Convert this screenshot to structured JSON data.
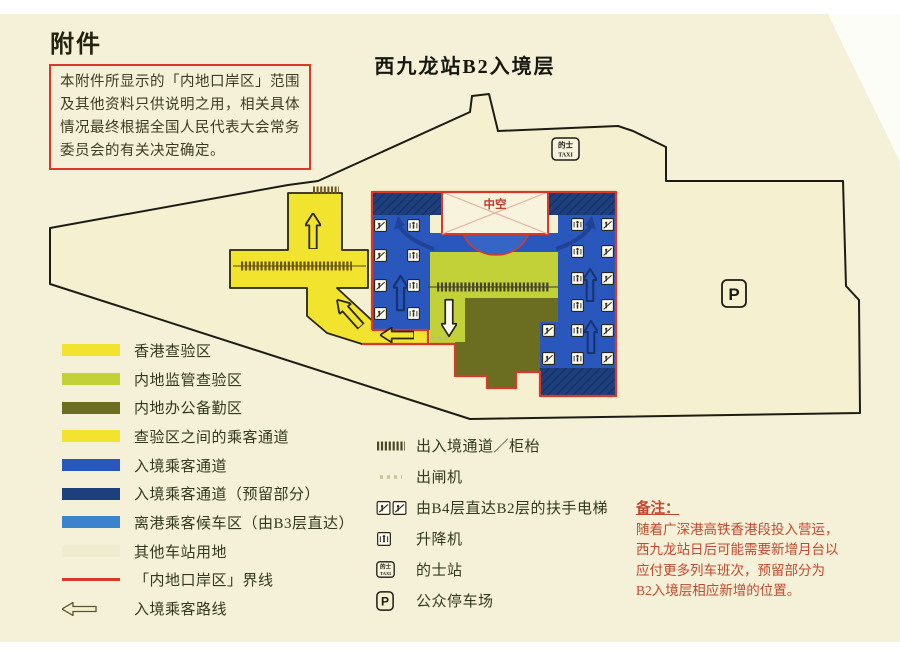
{
  "header": {
    "attachment_label": "附件",
    "disclaimer": "本附件所显示的「内地口岸区」范围及其他资料只供说明之用，相关具体情况最终根据全国人民代表大会常务委员会的有关决定确定。",
    "title": "西九龙站B2入境层"
  },
  "map": {
    "labels": {
      "void": "中空",
      "taxi_top": "的士",
      "taxi_bottom": "TAXI",
      "parking": "P"
    }
  },
  "area_legend": [
    {
      "label": "香港查验区",
      "color": "#f2e42e"
    },
    {
      "label": "内地监管查验区",
      "color": "#c2d138"
    },
    {
      "label": "内地办公备勤区",
      "color": "#6b6d20"
    },
    {
      "label": "查验区之间的乘客通道",
      "color": "#f2e42e"
    },
    {
      "label": "入境乘客通道",
      "color": "#2a57bb"
    },
    {
      "label": "入境乘客通道（预留部分）",
      "color": "#1d3f7e"
    },
    {
      "label": "离港乘客候车区（由B3层直达）",
      "color": "#3c82cd"
    },
    {
      "label": "其他车站用地",
      "color": "#f0ecd0"
    },
    {
      "label": "「内地口岸区」界线",
      "color": "#d8392b"
    },
    {
      "label": "入境乘客路线",
      "color": "#f3efcf"
    }
  ],
  "icon_legend": [
    {
      "icon": "counter-strip-icon",
      "label": "出入境通道／柜枱"
    },
    {
      "icon": "exit-gate-icon",
      "label": "出闸机"
    },
    {
      "icon": "escalator-pair-icon",
      "label": "由B4层直达B2层的扶手电梯"
    },
    {
      "icon": "lift-icon",
      "label": "升降机"
    },
    {
      "icon": "taxi-icon",
      "label": "的士站"
    },
    {
      "icon": "parking-icon",
      "label": "公众停车场"
    }
  ],
  "note": {
    "title": "备注：",
    "lines": [
      "随着广深港高铁香港段投入营运，",
      "西九龙站日后可能需要新增月台以",
      "应付更多列车班次，预留部分为",
      "B2入境层相应新增的位置。"
    ]
  },
  "colors": {
    "page_bg": "#f5f1d8",
    "station_fill": "#f4f0d0",
    "outline_black": "#1c1c14",
    "boundary_red": "#d8392b",
    "hk_yellow": "#f2e42e",
    "mainland_green": "#c2d138",
    "office_olive": "#6b6d20",
    "channel_blue": "#2a57bb",
    "reserved_navy": "#1d3f7e",
    "waiting_blue": "#3566c5",
    "note_text": "#c2492f"
  }
}
